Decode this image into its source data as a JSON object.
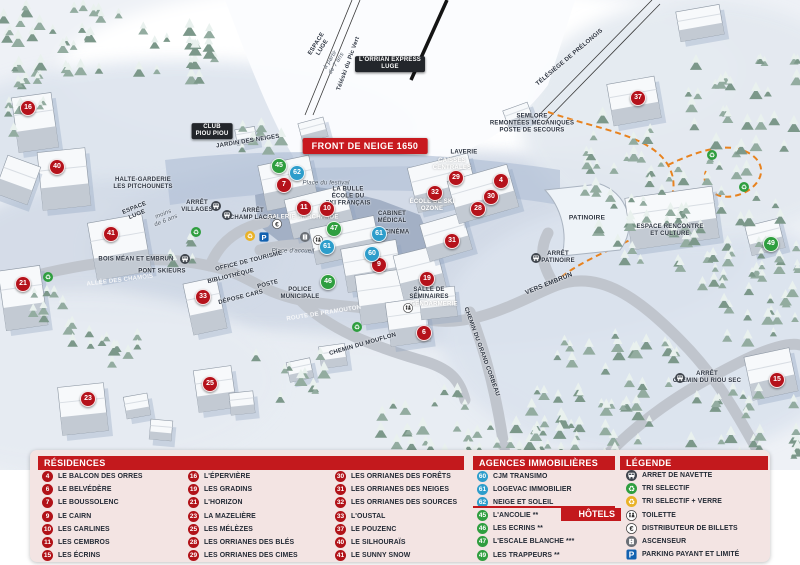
{
  "map": {
    "banner": "FRONT DE NEIGE 1650",
    "marker_colors": {
      "residence": "#b5121b",
      "hotel": "#2f9e3f",
      "agency": "#2d9dcb"
    },
    "markers": [
      {
        "n": "16",
        "kind": "residence",
        "x": 28,
        "y": 108
      },
      {
        "n": "40",
        "kind": "residence",
        "x": 57,
        "y": 167
      },
      {
        "n": "41",
        "kind": "residence",
        "x": 111,
        "y": 234
      },
      {
        "n": "21",
        "kind": "residence",
        "x": 23,
        "y": 284
      },
      {
        "n": "33",
        "kind": "residence",
        "x": 203,
        "y": 297
      },
      {
        "n": "23",
        "kind": "residence",
        "x": 88,
        "y": 399
      },
      {
        "n": "25",
        "kind": "residence",
        "x": 210,
        "y": 384
      },
      {
        "n": "7",
        "kind": "residence",
        "x": 284,
        "y": 185
      },
      {
        "n": "11",
        "kind": "residence",
        "x": 304,
        "y": 208
      },
      {
        "n": "10",
        "kind": "residence",
        "x": 327,
        "y": 209
      },
      {
        "n": "9",
        "kind": "residence",
        "x": 379,
        "y": 265
      },
      {
        "n": "6",
        "kind": "residence",
        "x": 424,
        "y": 333
      },
      {
        "n": "19",
        "kind": "residence",
        "x": 427,
        "y": 279
      },
      {
        "n": "31",
        "kind": "residence",
        "x": 452,
        "y": 241
      },
      {
        "n": "32",
        "kind": "residence",
        "x": 435,
        "y": 193
      },
      {
        "n": "29",
        "kind": "residence",
        "x": 456,
        "y": 178
      },
      {
        "n": "28",
        "kind": "residence",
        "x": 478,
        "y": 209
      },
      {
        "n": "30",
        "kind": "residence",
        "x": 491,
        "y": 197
      },
      {
        "n": "4",
        "kind": "residence",
        "x": 501,
        "y": 181
      },
      {
        "n": "37",
        "kind": "residence",
        "x": 638,
        "y": 98
      },
      {
        "n": "15",
        "kind": "residence",
        "x": 777,
        "y": 380
      },
      {
        "n": "45",
        "kind": "hotel",
        "x": 279,
        "y": 166
      },
      {
        "n": "47",
        "kind": "hotel",
        "x": 334,
        "y": 229
      },
      {
        "n": "46",
        "kind": "hotel",
        "x": 328,
        "y": 282
      },
      {
        "n": "49",
        "kind": "hotel",
        "x": 771,
        "y": 244
      },
      {
        "n": "62",
        "kind": "agency",
        "x": 297,
        "y": 173
      },
      {
        "n": "61",
        "kind": "agency",
        "x": 327,
        "y": 247
      },
      {
        "n": "61",
        "kind": "agency",
        "x": 379,
        "y": 234
      },
      {
        "n": "60",
        "kind": "agency",
        "x": 372,
        "y": 254
      }
    ],
    "labels": [
      {
        "t": "ESPACE\nLUGE",
        "x": 320,
        "y": 46,
        "rot": -58,
        "fs": 6,
        "v": "d"
      },
      {
        "t": "à partir\nde 7 ans",
        "x": 334,
        "y": 62,
        "rot": -58,
        "fs": 6,
        "v": "i"
      },
      {
        "t": "Téléski du Pic Vert",
        "x": 349,
        "y": 64,
        "rot": -70,
        "fs": 6,
        "v": "d"
      },
      {
        "t": "L'ORRIAN EXPRESS\nLUGE",
        "x": 390,
        "y": 64,
        "rot": 0,
        "fs": 6,
        "v": "b"
      },
      {
        "t": "TÉLÉSIÈGE DE PRÉLONGIS",
        "x": 570,
        "y": 58,
        "rot": -40,
        "fs": 6,
        "v": "d"
      },
      {
        "t": "SEMLORE\nREMONTÉES MÉCANIQUES\nPOSTE DE SECOURS",
        "x": 532,
        "y": 124,
        "rot": 0,
        "fs": 6,
        "v": "d"
      },
      {
        "t": "HALTE-GARDERIE\nLES PITCHOUNETS",
        "x": 143,
        "y": 184,
        "rot": 0,
        "fs": 6,
        "v": "d"
      },
      {
        "t": "ESPACE\nLUGE",
        "x": 136,
        "y": 212,
        "rot": -22,
        "fs": 6,
        "v": "d"
      },
      {
        "t": "moins\nde 6 ans",
        "x": 165,
        "y": 218,
        "rot": -22,
        "fs": 6,
        "v": "i"
      },
      {
        "t": "ARRÊT\nVILLAGES",
        "x": 197,
        "y": 207,
        "rot": 0,
        "fs": 6,
        "v": "d"
      },
      {
        "t": "ARRÊT\nCHAMP LACAS",
        "x": 253,
        "y": 215,
        "rot": 0,
        "fs": 6,
        "v": "d"
      },
      {
        "t": "CLUB\nPIOU PIOU",
        "x": 212,
        "y": 131,
        "rot": 0,
        "fs": 6,
        "v": "b"
      },
      {
        "t": "JARDIN DES NEIGES",
        "x": 248,
        "y": 142,
        "rot": -9,
        "fs": 6,
        "v": "d"
      },
      {
        "t": "Place du festival",
        "x": 326,
        "y": 184,
        "rot": 0,
        "fs": 6,
        "v": "i"
      },
      {
        "t": "LA BULLE\nÉCOLE DU\nSKI FRANÇAIS",
        "x": 348,
        "y": 197,
        "rot": 0,
        "fs": 6,
        "v": "d"
      },
      {
        "t": "GALERIE MARCHANDE",
        "x": 303,
        "y": 218,
        "rot": 0,
        "fs": 6,
        "v": "w"
      },
      {
        "t": "CAISSES\nCENTRALES",
        "x": 452,
        "y": 165,
        "rot": 0,
        "fs": 6,
        "v": "w"
      },
      {
        "t": "CABINET\nMÉDICAL",
        "x": 392,
        "y": 218,
        "rot": 0,
        "fs": 6,
        "v": "d"
      },
      {
        "t": "LAVERIE",
        "x": 464,
        "y": 153,
        "rot": 0,
        "fs": 6,
        "v": "d"
      },
      {
        "t": "ÉCOLE DE SKI\nOZONE",
        "x": 432,
        "y": 206,
        "rot": 0,
        "fs": 6,
        "v": "w"
      },
      {
        "t": "CINÉMA",
        "x": 397,
        "y": 233,
        "rot": 0,
        "fs": 6,
        "v": "d"
      },
      {
        "t": "Place d'accueil",
        "x": 293,
        "y": 252,
        "rot": 0,
        "fs": 6,
        "v": "i"
      },
      {
        "t": "OFFICE DE TOURISME",
        "x": 249,
        "y": 262,
        "rot": -14,
        "fs": 6,
        "v": "d"
      },
      {
        "t": "BIBLIOTHÈQUE",
        "x": 231,
        "y": 277,
        "rot": -14,
        "fs": 6,
        "v": "d"
      },
      {
        "t": "POSTE",
        "x": 268,
        "y": 285,
        "rot": -14,
        "fs": 6,
        "v": "d"
      },
      {
        "t": "DÉPOSE CARS",
        "x": 241,
        "y": 298,
        "rot": -14,
        "fs": 6,
        "v": "d"
      },
      {
        "t": "POLICE\nMUNICIPALE",
        "x": 300,
        "y": 294,
        "rot": 0,
        "fs": 6,
        "v": "d"
      },
      {
        "t": "SALLE DE\nSÉMINAIRES",
        "x": 429,
        "y": 294,
        "rot": 0,
        "fs": 6,
        "v": "d"
      },
      {
        "t": "GENDARMERIE",
        "x": 434,
        "y": 305,
        "rot": 0,
        "fs": 6,
        "v": "w"
      },
      {
        "t": "ALLÉE DES CHAMOIS",
        "x": 120,
        "y": 281,
        "rot": -7,
        "fs": 6,
        "v": "r"
      },
      {
        "t": "PONT SKIEURS",
        "x": 162,
        "y": 272,
        "rot": 0,
        "fs": 6,
        "v": "d"
      },
      {
        "t": "BOIS MÉAN ET EMBRUN",
        "x": 136,
        "y": 260,
        "rot": 0,
        "fs": 6,
        "v": "d"
      },
      {
        "t": "ROUTE DE PRAMOUTON",
        "x": 324,
        "y": 314,
        "rot": -9,
        "fs": 6,
        "v": "r"
      },
      {
        "t": "CHEMIN DU MOUFLON",
        "x": 363,
        "y": 345,
        "rot": -16,
        "fs": 6,
        "v": "d"
      },
      {
        "t": "CHEMIN DU GRAND CORBEAU",
        "x": 481,
        "y": 352,
        "rot": 70,
        "fs": 6,
        "v": "d"
      },
      {
        "t": "VERS EMBRUN",
        "x": 549,
        "y": 284,
        "rot": -22,
        "fs": 6.5,
        "v": "d"
      },
      {
        "t": "ARRÊT\nPATINOIRE",
        "x": 558,
        "y": 258,
        "rot": 0,
        "fs": 6,
        "v": "d"
      },
      {
        "t": "PATINOIRE",
        "x": 587,
        "y": 218,
        "rot": 0,
        "fs": 6.5,
        "v": "d"
      },
      {
        "t": "ESPACE RENCONTRE\nET CULTURE",
        "x": 670,
        "y": 231,
        "rot": 0,
        "fs": 6,
        "v": "d"
      },
      {
        "t": "ARRÊT\nCHEMIN DU RIOU SEC",
        "x": 707,
        "y": 378,
        "rot": 0,
        "fs": 6,
        "v": "d"
      }
    ],
    "icons": [
      {
        "type": "bus",
        "x": 216,
        "y": 206
      },
      {
        "type": "bus",
        "x": 227,
        "y": 215
      },
      {
        "type": "bus",
        "x": 185,
        "y": 259
      },
      {
        "type": "bus",
        "x": 536,
        "y": 258
      },
      {
        "type": "bus",
        "x": 680,
        "y": 378
      },
      {
        "type": "recycle-green",
        "x": 196,
        "y": 232
      },
      {
        "type": "recycle-green",
        "x": 48,
        "y": 277
      },
      {
        "type": "recycle-green",
        "x": 357,
        "y": 327
      },
      {
        "type": "recycle-green",
        "x": 712,
        "y": 155
      },
      {
        "type": "recycle-green",
        "x": 744,
        "y": 187
      },
      {
        "type": "recycle-yellow",
        "x": 250,
        "y": 236
      },
      {
        "type": "parking",
        "x": 264,
        "y": 237
      },
      {
        "type": "euro",
        "x": 277,
        "y": 224
      },
      {
        "type": "toilet",
        "x": 318,
        "y": 240
      },
      {
        "type": "toilet",
        "x": 408,
        "y": 308
      },
      {
        "type": "elevator",
        "x": 305,
        "y": 237
      }
    ]
  },
  "panel": {
    "residences": {
      "title": "RÉSIDENCES",
      "columns": [
        [
          {
            "num": "4",
            "name": "LE BALCON DES ORRES"
          },
          {
            "num": "6",
            "name": "LE BELVÉDÈRE"
          },
          {
            "num": "7",
            "name": "LE BOUSSOLENC"
          },
          {
            "num": "9",
            "name": "LE CAIRN"
          },
          {
            "num": "10",
            "name": "LES CARLINES"
          },
          {
            "num": "11",
            "name": "LES CEMBROS"
          },
          {
            "num": "15",
            "name": "LES ÉCRINS"
          }
        ],
        [
          {
            "num": "16",
            "name": "L'ÉPERVIÈRE"
          },
          {
            "num": "19",
            "name": "LES GRADINS"
          },
          {
            "num": "21",
            "name": "L'HORIZON"
          },
          {
            "num": "23",
            "name": "LA MAZELIÈRE"
          },
          {
            "num": "25",
            "name": "LES MÉLÈZES"
          },
          {
            "num": "28",
            "name": "LES ORRIANES DES BLÉS"
          },
          {
            "num": "29",
            "name": "LES ORRIANES DES CIMES"
          }
        ],
        [
          {
            "num": "30",
            "name": "LES ORRIANES DES FORÊTS"
          },
          {
            "num": "31",
            "name": "LES ORRIANES DES NEIGES"
          },
          {
            "num": "32",
            "name": "LES ORRIANES DES SOURCES"
          },
          {
            "num": "33",
            "name": "L'OUSTAL"
          },
          {
            "num": "37",
            "name": "LE POUZENC"
          },
          {
            "num": "40",
            "name": "LE SILHOURAÏS"
          },
          {
            "num": "41",
            "name": "LE SUNNY SNOW"
          }
        ]
      ]
    },
    "agencies": {
      "title": "AGENCES IMMOBILIÈRES",
      "items": [
        {
          "num": "60",
          "name": "CJM TRANSIMO"
        },
        {
          "num": "61",
          "name": "LOGEVAC IMMOBILIER"
        },
        {
          "num": "62",
          "name": "NEIGE ET SOLEIL"
        }
      ]
    },
    "hotels": {
      "title": "HÔTELS",
      "items": [
        {
          "num": "45",
          "name": "L'ANCOLIE **"
        },
        {
          "num": "46",
          "name": "LES ECRINS **"
        },
        {
          "num": "47",
          "name": "L'ESCALE BLANCHE ***"
        },
        {
          "num": "49",
          "name": "LES TRAPPEURS **"
        }
      ]
    },
    "legend": {
      "title": "LÉGENDE",
      "items": [
        {
          "icon": "bus",
          "label": "ARRET DE NAVETTE"
        },
        {
          "icon": "recycle-green",
          "label": "TRI SELECTIF"
        },
        {
          "icon": "recycle-yellow",
          "label": "TRI SELECTIF + VERRE"
        },
        {
          "icon": "toilet",
          "label": "TOILETTE"
        },
        {
          "icon": "euro",
          "label": "DISTRIBUTEUR DE BILLETS"
        },
        {
          "icon": "elevator",
          "label": "ASCENSEUR"
        },
        {
          "icon": "parking",
          "label": "PARKING PAYANT ET LIMITÉ"
        }
      ]
    },
    "colors": {
      "residence": "#b11218",
      "agency": "#2d9dcb",
      "hotel": "#2f9e3f",
      "header": "#c3191d"
    }
  }
}
